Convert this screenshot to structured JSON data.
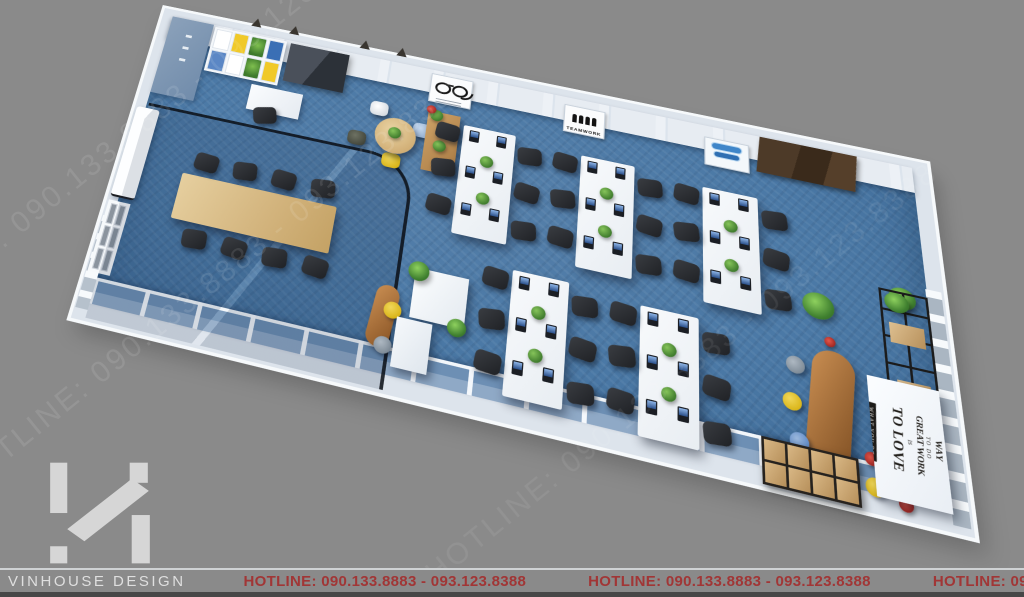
{
  "colors": {
    "background": "#8a8a8a",
    "carpet_blue": "#4b79a6",
    "wall_white": "#eef2f6",
    "hotline_red": "#a13636",
    "accent_yellow": "#e3c22f",
    "accent_blue": "#5b87c5",
    "wood": "#d2b37c",
    "chair_dark": "#2b2d31"
  },
  "watermark": {
    "text": "HOTLINE: 090.133.8883 - 093.123.8388"
  },
  "footer": {
    "brand": "VINHOUSE DESIGN",
    "hotline_left": "HOTLINE: 090.133.8883 - 093.123.8388",
    "hotline_center": "HOTLINE: 090.133.8883 - 093.123.8388",
    "hotline_right": "HOTLINE: 090.133.8883 - 093.123.8388"
  },
  "posters": {
    "teamwork_label": "TEAMWORK"
  },
  "quote_wall": {
    "line1": "THE ONLY WAY",
    "line2": "TO DO",
    "line3": "GREAT WORK",
    "line4": "IS",
    "line5": "TO LOVE",
    "line6": "WHAT YOU DO"
  }
}
